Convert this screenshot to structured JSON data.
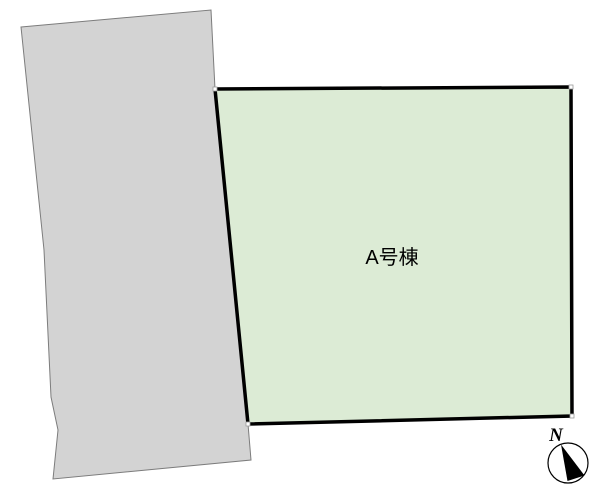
{
  "road": {
    "points": "21,27 211,10 215,89 248,424 251,460 53,479 58,430 51,397 44,250",
    "fill": "#d3d3d3",
    "stroke": "#7c7c7c"
  },
  "lot": {
    "label": "A号棟",
    "points": "215,89 571,87 572,416 248,424",
    "fill": "#dcebd5",
    "stroke": "#000000",
    "label_x": 392,
    "label_y": 264,
    "marker_size": 4,
    "vertex_markers": [
      {
        "x": 213,
        "y": 87
      },
      {
        "x": 569,
        "y": 85
      },
      {
        "x": 570,
        "y": 414
      },
      {
        "x": 246,
        "y": 422
      }
    ]
  },
  "compass": {
    "label": "N",
    "cx": 568,
    "cy": 463,
    "r": 20,
    "needle_points": "561,444.5 567.5,481 584.5,475.5",
    "needle_color": "#000000",
    "label_x": 556,
    "label_y": 441
  }
}
